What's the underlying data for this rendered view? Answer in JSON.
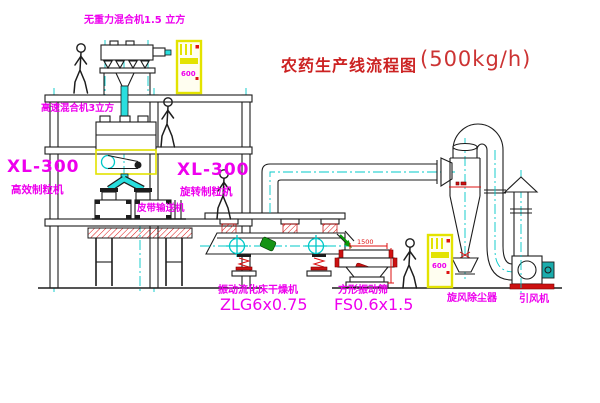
{
  "diagram": {
    "title": {
      "main": "农药生产线流程图",
      "capacity": "(500kg/h)"
    },
    "equipment_labels": {
      "gravity_mixer": "无重力混合机1.5 立方",
      "high_speed_mixer": "高速混合机3立方",
      "granulator_left_model": "XL-300",
      "granulator_left_name": "高效制粒机",
      "granulator_right_model": "XL-300",
      "granulator_right_name": "旋转制粒机",
      "belt_conveyor": "皮带输送机",
      "fluid_bed_dryer_name": "振动流化床干燥机",
      "fluid_bed_dryer_model": "ZLG6x0.75",
      "square_sieve_name": "方形振动筛",
      "square_sieve_model": "FS0.6x1.5",
      "cyclone": "旋风除尘器",
      "induced_draft_fan": "引风机"
    },
    "dimensions": {
      "sieve_width": "1500"
    },
    "control_panels": {
      "panel1_text": "600",
      "panel2_text": "600"
    },
    "colors": {
      "line_cyan": "#00c8c8",
      "label_magenta": "#ee00ee",
      "title_red": "#cc2222",
      "cabinet_yellow": "#e3e300",
      "accent_red": "#dd1111",
      "motor_green": "#159315"
    }
  }
}
